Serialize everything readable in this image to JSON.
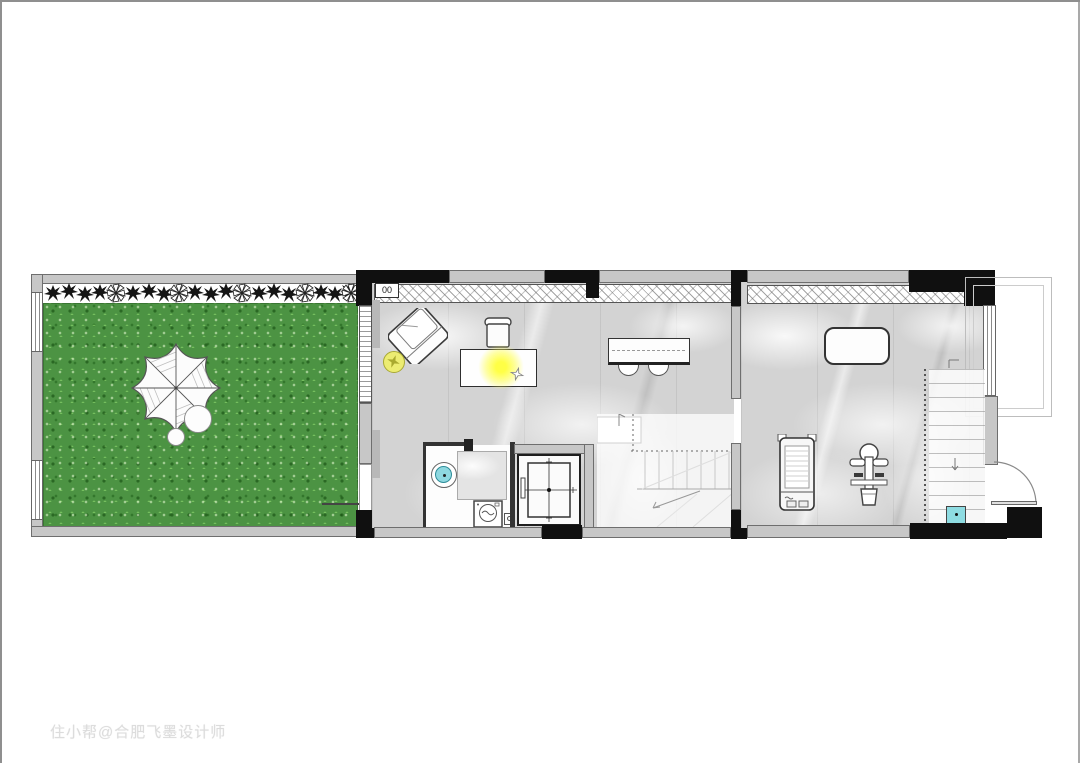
{
  "watermark": {
    "text": "住小帮@合肥飞墨设计师"
  },
  "labels": {
    "corner_box": "00"
  },
  "colors": {
    "page-border": "#8f8f8f",
    "wall-gray": "#c7c7c7",
    "wall-dark": "#101010",
    "wall-edge": "#6e6e6e",
    "grass-green": "#4c9343",
    "marble-gray": "#d3d3d3",
    "counter-gray": "#e4e4e4",
    "sink-cyan": "#8ed8e0",
    "step-cyan": "#8edce2",
    "pouf-yellow": "#ecec72",
    "lamp-glow": "#ffff55",
    "line-dark": "#3a3a3a",
    "stair-line": "#c8c8c8"
  },
  "icon_names": [
    "parasol-icon",
    "garden-table-icon",
    "garden-stool-icon",
    "shrub-icon",
    "pinwheel-flower-icon",
    "armchair-icon",
    "pouf-icon",
    "desk-icon",
    "desk-chair-icon",
    "lamp-glow-icon",
    "sketch-star-icon",
    "bar-table-icon",
    "bar-stool-icon",
    "sink-icon",
    "washing-machine-icon",
    "floor-drain-icon",
    "elevator-icon",
    "stairs-icon",
    "treadmill-icon",
    "exercise-machine-icon",
    "gym-mat-icon",
    "entry-door-icon",
    "shoe-step-icon",
    "window-icon"
  ]
}
